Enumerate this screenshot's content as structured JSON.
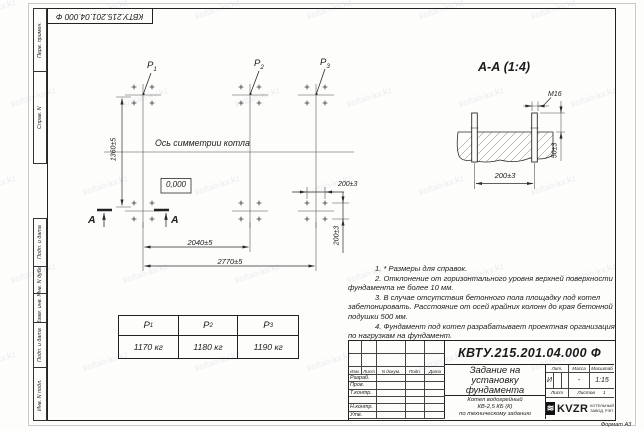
{
  "watermark": "kotlah-kv.kz",
  "corner_stamp": "КВТУ.215.201.04.000 Ф",
  "margin_labels": [
    "Перв. примен.",
    "Справ. N",
    "Подп. и дата",
    "Инв. N дубл.",
    "Взам. инв. N",
    "Подп. и дата",
    "Инв. N подл."
  ],
  "plan": {
    "points": [
      {
        "base": "P",
        "sub": "1"
      },
      {
        "base": "P",
        "sub": "2"
      },
      {
        "base": "P",
        "sub": "3"
      }
    ],
    "axis_label": "Ось симметрии котла",
    "level_mark": "0,000",
    "dim_height": "1360±5",
    "dim_span_inner": "2040±5",
    "dim_span_outer": "2770±5",
    "dim_bolt_x": "200±3",
    "dim_bolt_y": "200±3",
    "section_letter_1": "А",
    "section_letter_2": "А"
  },
  "section": {
    "title": "А-А (1:4)",
    "bolt_thread": "М16",
    "dim_protrusion": "50±3",
    "dim_spacing": "200±3"
  },
  "notes": {
    "lines": [
      "1. * Размеры для справок.",
      "2. Отклонение от горизонтального уровня верхней поверхности",
      "фундамента не более 10 мм.",
      "3. В случае отсутствия бетонного пола площадку под котел",
      "забетонировать. Расстояние от осей крайних колонн до края бетонной",
      "подушки 500 мм.",
      "4. Фундамент под котел разрабатывает проектная организация",
      "по нагрузкам на фундамент."
    ]
  },
  "load_table": {
    "columns": [
      {
        "base": "P",
        "sub": "1",
        "value": "1170 кг"
      },
      {
        "base": "P",
        "sub": "2",
        "value": "1180 кг"
      },
      {
        "base": "P",
        "sub": "3",
        "value": "1190 кг"
      }
    ]
  },
  "title_block": {
    "designation": "КВТУ.215.201.04.000 Ф",
    "doc_title_line1": "Задание на",
    "doc_title_line2": "установку",
    "doc_title_line3": "фундамента",
    "product_line1": "Котел водогрейный",
    "product_line2": "КВ-2,5 КБ (К)",
    "product_line3": "по техническому заданию",
    "header": {
      "izm": "Изм.",
      "list": "Лист",
      "ndoc": "N докум.",
      "podp": "Подп.",
      "data": "Дата"
    },
    "rows": [
      "Разраб.",
      "Пров.",
      "Т.контр.",
      "",
      "Н.контр.",
      "Утв."
    ],
    "lit_label": "Лит.",
    "mass_label": "Масса",
    "scale_label": "Масштаб",
    "lit_value": "И",
    "mass_value": "-",
    "scale_value": "1:15",
    "sheet_label": "Лист",
    "sheets_label": "Листов",
    "sheets_value": "1",
    "logo_text": "KVZR",
    "logo_sub1": "КОТЕЛЬНЫЙ",
    "logo_sub2": "ЗАВОД, РЭП",
    "format_label": "Формат А3"
  }
}
